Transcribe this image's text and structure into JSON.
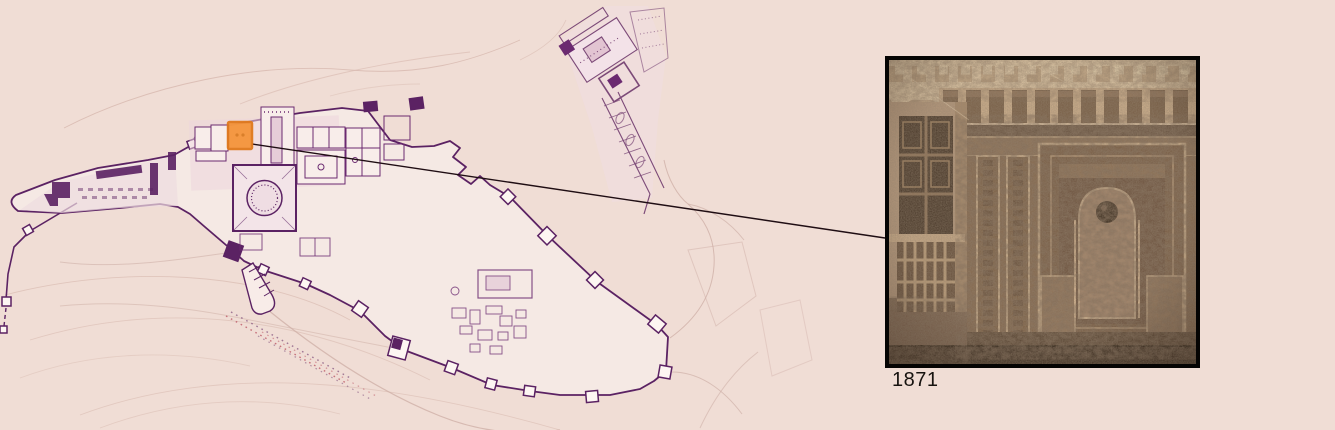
{
  "page": {
    "background_color": "#f0ddd5"
  },
  "map": {
    "name": "alhambra-site-plan",
    "ink_color": "#5b2263",
    "wash_color": "#ecd6dc",
    "contour_color": "#d8bab0",
    "highlight": {
      "color": "#f5953b",
      "border_color": "#e0791c"
    }
  },
  "callout": {
    "connector_color": "#1f0d13",
    "photo": {
      "border_color": "#050403",
      "description": "sepia photograph of carved stucco niche beside a wooden window"
    },
    "caption": "1871"
  }
}
